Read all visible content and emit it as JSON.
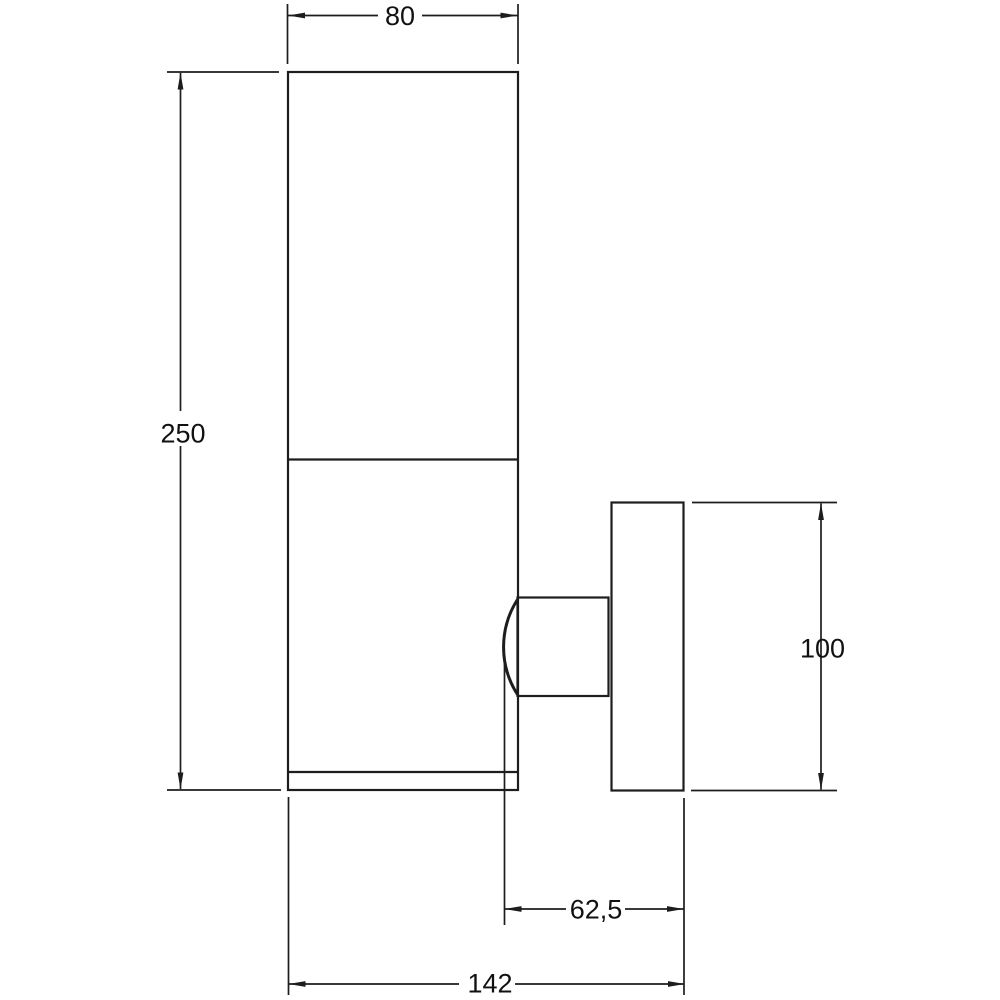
{
  "drawing": {
    "type": "technical-dimension-drawing",
    "subject": "wall-mounted cylindrical lamp, side view",
    "background_color": "#ffffff",
    "line_color": "#1d1d1d",
    "text_color": "#111111",
    "labels": {
      "body_width": "80",
      "body_height": "250",
      "backplate_height": "100",
      "wall_to_body": "62,5",
      "total_depth": "142"
    }
  }
}
